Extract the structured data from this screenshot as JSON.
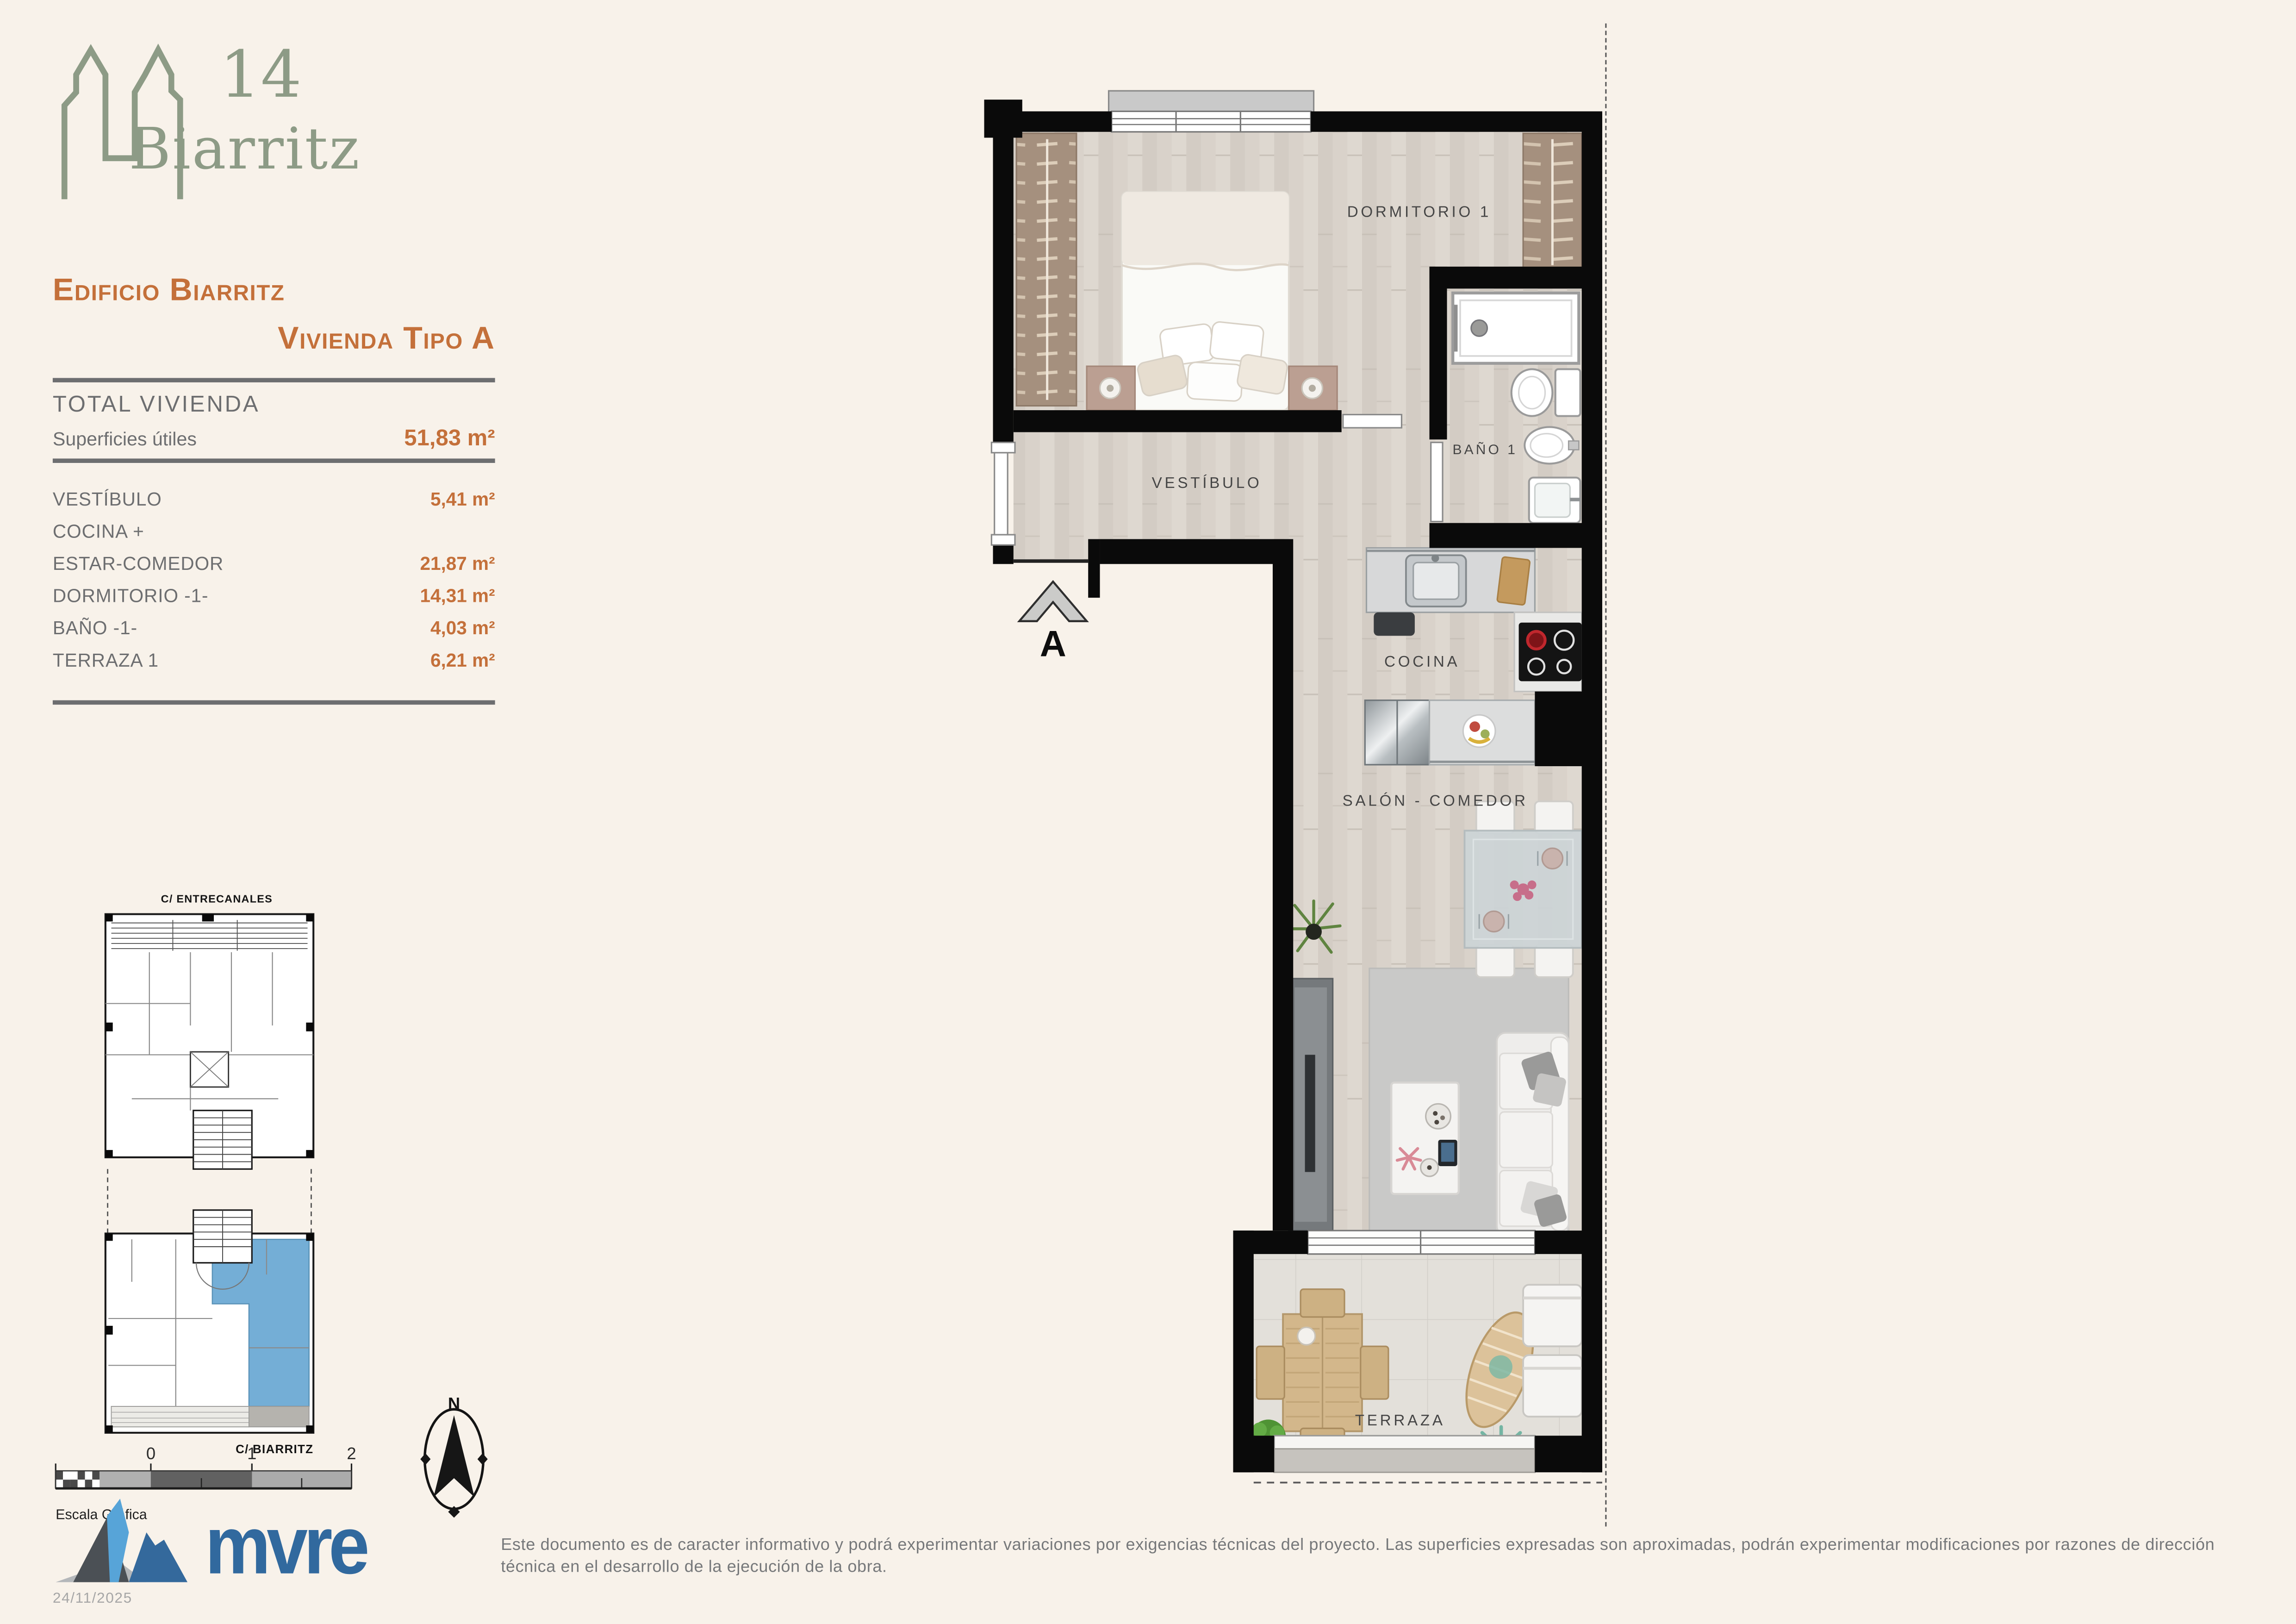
{
  "colors": {
    "background": "#f8f2ea",
    "accent_orange": "#c4703a",
    "text_gray": "#6d6e70",
    "logo_sage": "#8d9b86",
    "brand_blue": "#31699e",
    "keyplan_highlight": "#74aed6",
    "wall_black": "#0a0a0a"
  },
  "logo": {
    "number": "14",
    "name": "Biarritz"
  },
  "header": {
    "title_line1": "Edificio Biarritz",
    "title_line2": "Vivienda Tipo A"
  },
  "summary": {
    "heading": "TOTAL VIVIENDA",
    "label": "Superficies útiles",
    "value": "51,83 m²"
  },
  "rooms_table": {
    "rows": [
      {
        "label": "VESTÍBULO",
        "value": "5,41 m²"
      },
      {
        "label": "COCINA +",
        "value": ""
      },
      {
        "label": "ESTAR-COMEDOR",
        "value": "21,87 m²"
      },
      {
        "label": "DORMITORIO -1-",
        "value": "14,31 m²"
      },
      {
        "label": "BAÑO -1-",
        "value": "4,03 m²"
      },
      {
        "label": "TERRAZA 1",
        "value": "6,21 m²"
      }
    ]
  },
  "floor_plan": {
    "labels": {
      "bedroom": "DORMITORIO 1",
      "bathroom": "BAÑO 1",
      "hall": "VESTÍBULO",
      "kitchen": "COCINA",
      "living": "SALÓN - COMEDOR",
      "terrace": "TERRAZA"
    },
    "section_marker": "A"
  },
  "key_plan": {
    "street_top": "C/ ENTRECANALES",
    "street_bottom": "C/ BIARRITZ"
  },
  "scale_bar": {
    "ticks": [
      "0",
      "1",
      "2"
    ],
    "caption": "Escala Gráfica"
  },
  "compass": {
    "north_label": "N"
  },
  "brand": {
    "wordmark": "mvre",
    "date": "24/11/2025"
  },
  "disclaimer": {
    "text": "Este documento es de caracter informativo y podrá experimentar variaciones por exigencias técnicas del proyecto. Las superficies expresadas son aproximadas, podrán experimentar modificaciones por razones de dirección técnica en el desarrollo de la ejecución de la obra."
  }
}
